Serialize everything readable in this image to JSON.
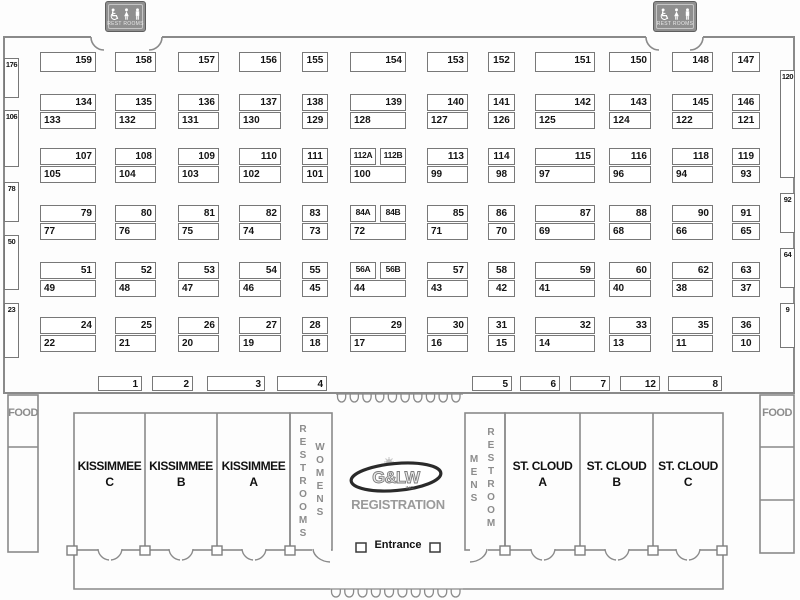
{
  "signs": {
    "left": {
      "label": "REST ROOMS"
    },
    "right": {
      "label": "REST ROOMS"
    }
  },
  "labels": {
    "food_left": "FOOD",
    "food_right": "FOOD",
    "entrance": "Entrance",
    "registration": "REGISTRATION",
    "logo_text": "G&LW",
    "logo_sub": "INC."
  },
  "rooms": {
    "kissimmee_c": {
      "line1": "KISSIMMEE",
      "line2": "C"
    },
    "kissimmee_b": {
      "line1": "KISSIMMEE",
      "line2": "B"
    },
    "kissimmee_a": {
      "line1": "KISSIMMEE",
      "line2": "A"
    },
    "stcloud_a": {
      "line1": "ST. CLOUD",
      "line2": "A"
    },
    "stcloud_b": {
      "line1": "ST. CLOUD",
      "line2": "B"
    },
    "stcloud_c": {
      "line1": "ST. CLOUD",
      "line2": "C"
    },
    "womens_restrooms": {
      "text1": "RESTROOMS",
      "text2": "WOMENS"
    },
    "mens_restroom": {
      "text1": "MENS",
      "text2": "RESTROOM"
    }
  },
  "colors": {
    "wall": "#8a8a8a",
    "booth_border": "#787878",
    "sign_bg": "#8f8f8f",
    "gray_text": "#8c8c8c",
    "ink": "#141414"
  },
  "booths": [
    [
      "159",
      40,
      52,
      56,
      20,
      "r"
    ],
    [
      "158",
      115,
      52,
      41,
      20,
      "r"
    ],
    [
      "157",
      178,
      52,
      41,
      20,
      "r"
    ],
    [
      "156",
      239,
      52,
      42,
      20,
      "r"
    ],
    [
      "155",
      302,
      52,
      26,
      20,
      "c"
    ],
    [
      "154",
      350,
      52,
      56,
      20,
      "r"
    ],
    [
      "153",
      427,
      52,
      41,
      20,
      "r"
    ],
    [
      "152",
      488,
      52,
      27,
      20,
      "c"
    ],
    [
      "151",
      535,
      52,
      60,
      20,
      "r"
    ],
    [
      "150",
      609,
      52,
      42,
      20,
      "r"
    ],
    [
      "148",
      672,
      52,
      41,
      20,
      "r"
    ],
    [
      "147",
      732,
      52,
      28,
      20,
      "c"
    ],
    [
      "134",
      40,
      94,
      56,
      17,
      "r"
    ],
    [
      "135",
      115,
      94,
      41,
      17,
      "r"
    ],
    [
      "136",
      178,
      94,
      41,
      17,
      "r"
    ],
    [
      "137",
      239,
      94,
      42,
      17,
      "r"
    ],
    [
      "138",
      302,
      94,
      26,
      17,
      "c"
    ],
    [
      "139",
      350,
      94,
      56,
      17,
      "r"
    ],
    [
      "140",
      427,
      94,
      41,
      17,
      "r"
    ],
    [
      "141",
      488,
      94,
      27,
      17,
      "c"
    ],
    [
      "142",
      535,
      94,
      60,
      17,
      "r"
    ],
    [
      "143",
      609,
      94,
      42,
      17,
      "r"
    ],
    [
      "145",
      672,
      94,
      41,
      17,
      "r"
    ],
    [
      "146",
      732,
      94,
      28,
      17,
      "c"
    ],
    [
      "133",
      40,
      112,
      56,
      17,
      "l"
    ],
    [
      "132",
      115,
      112,
      41,
      17,
      "l"
    ],
    [
      "131",
      178,
      112,
      41,
      17,
      "l"
    ],
    [
      "130",
      239,
      112,
      42,
      17,
      "l"
    ],
    [
      "129",
      302,
      112,
      26,
      17,
      "c"
    ],
    [
      "128",
      350,
      112,
      56,
      17,
      "l"
    ],
    [
      "127",
      427,
      112,
      41,
      17,
      "l"
    ],
    [
      "126",
      488,
      112,
      27,
      17,
      "c"
    ],
    [
      "125",
      535,
      112,
      60,
      17,
      "l"
    ],
    [
      "124",
      609,
      112,
      42,
      17,
      "l"
    ],
    [
      "122",
      672,
      112,
      41,
      17,
      "l"
    ],
    [
      "121",
      732,
      112,
      28,
      17,
      "c"
    ],
    [
      "107",
      40,
      148,
      56,
      17,
      "r"
    ],
    [
      "108",
      115,
      148,
      41,
      17,
      "r"
    ],
    [
      "109",
      178,
      148,
      41,
      17,
      "r"
    ],
    [
      "110",
      239,
      148,
      42,
      17,
      "r"
    ],
    [
      "111",
      302,
      148,
      26,
      17,
      "c"
    ],
    [
      "112A",
      350,
      148,
      26,
      17,
      "c"
    ],
    [
      "112B",
      380,
      148,
      26,
      17,
      "c"
    ],
    [
      "113",
      427,
      148,
      41,
      17,
      "r"
    ],
    [
      "114",
      488,
      148,
      27,
      17,
      "c"
    ],
    [
      "115",
      535,
      148,
      60,
      17,
      "r"
    ],
    [
      "116",
      609,
      148,
      42,
      17,
      "r"
    ],
    [
      "118",
      672,
      148,
      41,
      17,
      "r"
    ],
    [
      "119",
      732,
      148,
      28,
      17,
      "c"
    ],
    [
      "105",
      40,
      166,
      56,
      17,
      "l"
    ],
    [
      "104",
      115,
      166,
      41,
      17,
      "l"
    ],
    [
      "103",
      178,
      166,
      41,
      17,
      "l"
    ],
    [
      "102",
      239,
      166,
      42,
      17,
      "l"
    ],
    [
      "101",
      302,
      166,
      26,
      17,
      "c"
    ],
    [
      "100",
      350,
      166,
      56,
      17,
      "l"
    ],
    [
      "99",
      427,
      166,
      41,
      17,
      "l"
    ],
    [
      "98",
      488,
      166,
      27,
      17,
      "c"
    ],
    [
      "97",
      535,
      166,
      60,
      17,
      "l"
    ],
    [
      "96",
      609,
      166,
      42,
      17,
      "l"
    ],
    [
      "94",
      672,
      166,
      41,
      17,
      "l"
    ],
    [
      "93",
      732,
      166,
      28,
      17,
      "c"
    ],
    [
      "79",
      40,
      205,
      56,
      17,
      "r"
    ],
    [
      "80",
      115,
      205,
      41,
      17,
      "r"
    ],
    [
      "81",
      178,
      205,
      41,
      17,
      "r"
    ],
    [
      "82",
      239,
      205,
      42,
      17,
      "r"
    ],
    [
      "83",
      302,
      205,
      26,
      17,
      "c"
    ],
    [
      "84A",
      350,
      205,
      26,
      17,
      "c"
    ],
    [
      "84B",
      380,
      205,
      26,
      17,
      "c"
    ],
    [
      "85",
      427,
      205,
      41,
      17,
      "r"
    ],
    [
      "86",
      488,
      205,
      27,
      17,
      "c"
    ],
    [
      "87",
      535,
      205,
      60,
      17,
      "r"
    ],
    [
      "88",
      609,
      205,
      42,
      17,
      "r"
    ],
    [
      "90",
      672,
      205,
      41,
      17,
      "r"
    ],
    [
      "91",
      732,
      205,
      28,
      17,
      "c"
    ],
    [
      "77",
      40,
      223,
      56,
      17,
      "l"
    ],
    [
      "76",
      115,
      223,
      41,
      17,
      "l"
    ],
    [
      "75",
      178,
      223,
      41,
      17,
      "l"
    ],
    [
      "74",
      239,
      223,
      42,
      17,
      "l"
    ],
    [
      "73",
      302,
      223,
      26,
      17,
      "c"
    ],
    [
      "72",
      350,
      223,
      56,
      17,
      "l"
    ],
    [
      "71",
      427,
      223,
      41,
      17,
      "l"
    ],
    [
      "70",
      488,
      223,
      27,
      17,
      "c"
    ],
    [
      "69",
      535,
      223,
      60,
      17,
      "l"
    ],
    [
      "68",
      609,
      223,
      42,
      17,
      "l"
    ],
    [
      "66",
      672,
      223,
      41,
      17,
      "l"
    ],
    [
      "65",
      732,
      223,
      28,
      17,
      "c"
    ],
    [
      "51",
      40,
      262,
      56,
      17,
      "r"
    ],
    [
      "52",
      115,
      262,
      41,
      17,
      "r"
    ],
    [
      "53",
      178,
      262,
      41,
      17,
      "r"
    ],
    [
      "54",
      239,
      262,
      42,
      17,
      "r"
    ],
    [
      "55",
      302,
      262,
      26,
      17,
      "c"
    ],
    [
      "56A",
      350,
      262,
      26,
      17,
      "c"
    ],
    [
      "56B",
      380,
      262,
      26,
      17,
      "c"
    ],
    [
      "57",
      427,
      262,
      41,
      17,
      "r"
    ],
    [
      "58",
      488,
      262,
      27,
      17,
      "c"
    ],
    [
      "59",
      535,
      262,
      60,
      17,
      "r"
    ],
    [
      "60",
      609,
      262,
      42,
      17,
      "r"
    ],
    [
      "62",
      672,
      262,
      41,
      17,
      "r"
    ],
    [
      "63",
      732,
      262,
      28,
      17,
      "c"
    ],
    [
      "49",
      40,
      280,
      56,
      17,
      "l"
    ],
    [
      "48",
      115,
      280,
      41,
      17,
      "l"
    ],
    [
      "47",
      178,
      280,
      41,
      17,
      "l"
    ],
    [
      "46",
      239,
      280,
      42,
      17,
      "l"
    ],
    [
      "45",
      302,
      280,
      26,
      17,
      "c"
    ],
    [
      "44",
      350,
      280,
      56,
      17,
      "l"
    ],
    [
      "43",
      427,
      280,
      41,
      17,
      "l"
    ],
    [
      "42",
      488,
      280,
      27,
      17,
      "c"
    ],
    [
      "41",
      535,
      280,
      60,
      17,
      "l"
    ],
    [
      "40",
      609,
      280,
      42,
      17,
      "l"
    ],
    [
      "38",
      672,
      280,
      41,
      17,
      "l"
    ],
    [
      "37",
      732,
      280,
      28,
      17,
      "c"
    ],
    [
      "24",
      40,
      317,
      56,
      17,
      "r"
    ],
    [
      "25",
      115,
      317,
      41,
      17,
      "r"
    ],
    [
      "26",
      178,
      317,
      41,
      17,
      "r"
    ],
    [
      "27",
      239,
      317,
      42,
      17,
      "r"
    ],
    [
      "28",
      302,
      317,
      26,
      17,
      "c"
    ],
    [
      "29",
      350,
      317,
      56,
      17,
      "r"
    ],
    [
      "30",
      427,
      317,
      41,
      17,
      "r"
    ],
    [
      "31",
      488,
      317,
      27,
      17,
      "c"
    ],
    [
      "32",
      535,
      317,
      60,
      17,
      "r"
    ],
    [
      "33",
      609,
      317,
      42,
      17,
      "r"
    ],
    [
      "35",
      672,
      317,
      41,
      17,
      "r"
    ],
    [
      "36",
      732,
      317,
      28,
      17,
      "c"
    ],
    [
      "22",
      40,
      335,
      56,
      17,
      "l"
    ],
    [
      "21",
      115,
      335,
      41,
      17,
      "l"
    ],
    [
      "20",
      178,
      335,
      41,
      17,
      "l"
    ],
    [
      "19",
      239,
      335,
      42,
      17,
      "l"
    ],
    [
      "18",
      302,
      335,
      26,
      17,
      "c"
    ],
    [
      "17",
      350,
      335,
      56,
      17,
      "l"
    ],
    [
      "16",
      427,
      335,
      41,
      17,
      "l"
    ],
    [
      "15",
      488,
      335,
      27,
      17,
      "c"
    ],
    [
      "14",
      535,
      335,
      60,
      17,
      "l"
    ],
    [
      "13",
      609,
      335,
      42,
      17,
      "l"
    ],
    [
      "11",
      672,
      335,
      41,
      17,
      "l"
    ],
    [
      "10",
      732,
      335,
      28,
      17,
      "c"
    ],
    [
      "1",
      98,
      376,
      44,
      15,
      "r"
    ],
    [
      "2",
      152,
      376,
      41,
      15,
      "r"
    ],
    [
      "3",
      207,
      376,
      58,
      15,
      "r"
    ],
    [
      "4",
      277,
      376,
      50,
      15,
      "r"
    ],
    [
      "5",
      472,
      376,
      40,
      15,
      "r"
    ],
    [
      "6",
      520,
      376,
      40,
      15,
      "r"
    ],
    [
      "7",
      570,
      376,
      40,
      15,
      "r"
    ],
    [
      "12",
      620,
      376,
      40,
      15,
      "r"
    ],
    [
      "8",
      668,
      376,
      54,
      15,
      "r"
    ],
    [
      "176",
      4,
      58,
      15,
      40,
      "c"
    ],
    [
      "106",
      4,
      110,
      15,
      57,
      "c"
    ],
    [
      "78",
      4,
      182,
      15,
      40,
      "c"
    ],
    [
      "50",
      4,
      235,
      15,
      55,
      "c"
    ],
    [
      "23",
      4,
      303,
      15,
      55,
      "c"
    ],
    [
      "120",
      780,
      70,
      15,
      108,
      "c"
    ],
    [
      "92",
      780,
      193,
      15,
      40,
      "c"
    ],
    [
      "64",
      780,
      248,
      15,
      40,
      "c"
    ],
    [
      "9",
      780,
      303,
      15,
      45,
      "c"
    ]
  ]
}
